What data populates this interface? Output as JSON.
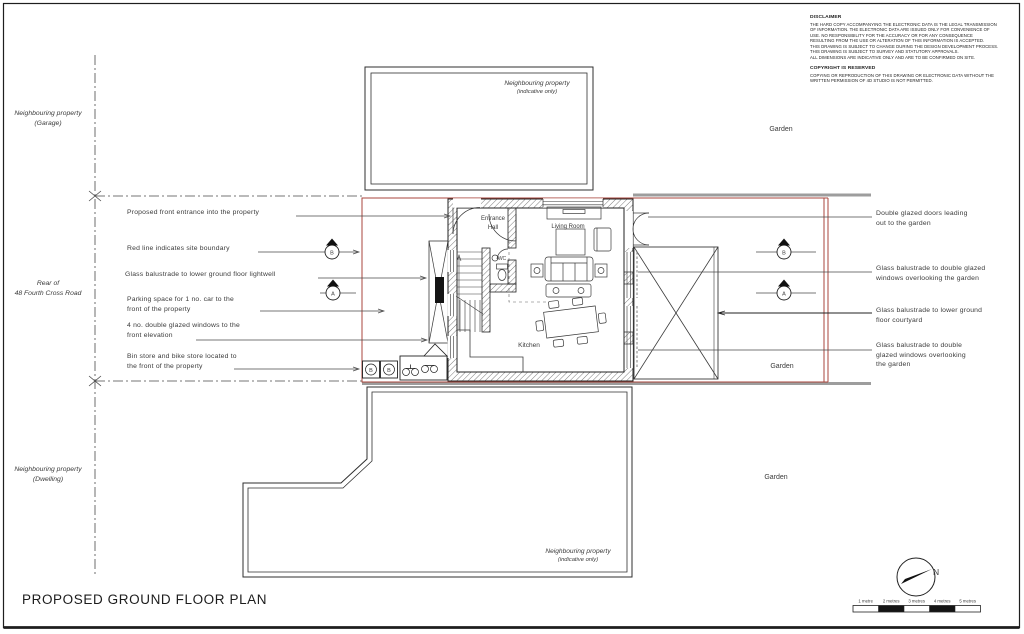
{
  "sheet": {
    "title": "PROPOSED GROUND FLOOR PLAN"
  },
  "disclaimer": {
    "heading": "DISCLAIMER",
    "lines": [
      "THE HARD COPY ACCOMPANYING THE ELECTRONIC DATA IS THE LEGAL TRANSMISSION",
      "OF INFORMATION. THE ELECTRONIC DATA ARE ISSUED ONLY FOR CONVENIENCE OF",
      "USE. NO RESPONSIBILITY FOR THE ACCURACY OR FOR ANY CONSEQUENCE",
      "RESULTING FROM THE USE OR ALTERATION OF THIS INFORMATION IS ACCEPTED.",
      "THIS DRAWING IS SUBJECT TO CHANGE DURING THE DESIGN DEVELOPMENT PROCESS.",
      "THIS DRAWING IS SUBJECT TO SURVEY AND STATUTORY APPROVALS.",
      "ALL DIMENSIONS ARE INDICATIVE ONLY AND ARE TO BE CONFIRMED ON SITE."
    ],
    "copyright_heading": "COPYRIGHT IS RESERVED",
    "copyright_lines": [
      "COPYING OR REPRODUCTION OF THIS DRAWING OR ELECTRONIC DATA WITHOUT THE",
      "WRITTEN PERMISSION OF 4D STUDIO IS NOT PERMITTED."
    ]
  },
  "context_labels": {
    "garage": [
      "Neighbouring property",
      "(Garage)"
    ],
    "road": [
      "Rear of",
      "48 Fourth Cross Road"
    ],
    "dwelling": [
      "Neighbouring property",
      "(Dwelling)"
    ],
    "neighbour_top": [
      "Neighbouring property",
      "(indicative only)"
    ],
    "neighbour_bottom": [
      "Neighbouring property",
      "(indicative only)"
    ],
    "garden_top": "Garden",
    "garden_middle": "Garden",
    "garden_bottom": "Garden"
  },
  "annotations_left": [
    {
      "lines": [
        "Proposed front entrance into the property"
      ]
    },
    {
      "lines": [
        "Red line indicates site boundary"
      ]
    },
    {
      "lines": [
        "Glass balustrade to lower ground floor lightwell"
      ]
    },
    {
      "lines": [
        "Parking space for 1 no. car to the",
        "front of the property"
      ]
    },
    {
      "lines": [
        "4 no. double glazed windows to the",
        "front elevation"
      ]
    },
    {
      "lines": [
        "Bin store and bike store located to",
        "the front of the property"
      ]
    }
  ],
  "annotations_right": [
    {
      "lines": [
        "Double glazed doors leading",
        "out to the garden"
      ]
    },
    {
      "lines": [
        "Glass balustrade to double glazed",
        "windows overlooking the garden"
      ]
    },
    {
      "lines": [
        "Glass balustrade to lower ground",
        "floor courtyard"
      ]
    },
    {
      "lines": [
        "Glass balustrade to double",
        "glazed windows overlooking",
        "the garden"
      ]
    }
  ],
  "plan": {
    "rooms": {
      "entrance_hall": [
        "Entrance",
        "Hall"
      ],
      "living_room": "Living Room",
      "wc": "WC",
      "kitchen": "Kitchen"
    },
    "section_markers": {
      "a": "A",
      "b": "B"
    },
    "bin_label": "B"
  },
  "scale_bar": {
    "labels": [
      "1 metre",
      "2 metres",
      "3 metres",
      "4 metres",
      "5 metres"
    ]
  },
  "north_label": "N",
  "colors": {
    "boundary_red": "#a8453c",
    "context_gray": "#9d9d9d",
    "line_dark": "#2f2f2f"
  }
}
